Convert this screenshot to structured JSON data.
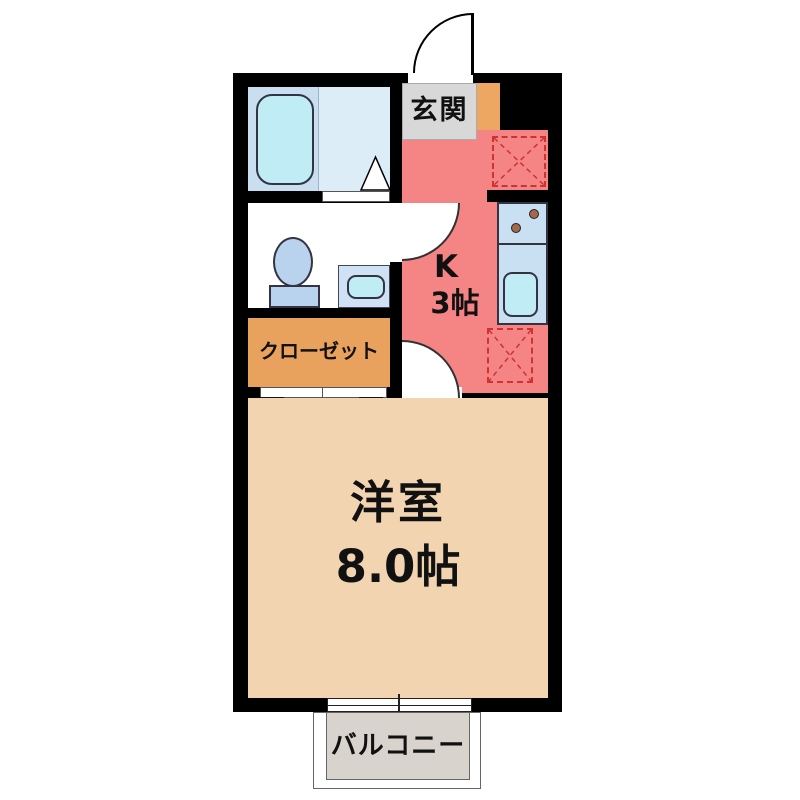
{
  "floorplan": {
    "rooms": {
      "entrance": {
        "label": "玄関"
      },
      "kitchen": {
        "label": "K",
        "size": "3帖"
      },
      "closet": {
        "label": "クローゼット"
      },
      "western_room": {
        "label": "洋室",
        "size": "8.0帖"
      },
      "balcony": {
        "label": "バルコニー"
      }
    },
    "fixtures": [
      "bathtub-icon",
      "bathroom-door-triangle-icon",
      "toilet-icon",
      "toilet-sink-icon",
      "entrance-door-arc-icon",
      "interior-door-arc-icon",
      "kitchen-counter-icon",
      "stove-burner-icon",
      "kitchen-sink-icon",
      "appliance-space-dashed-icon",
      "closet-door-triangle-icon",
      "sliding-window-icon"
    ],
    "colors": {
      "wall": "#000000",
      "kitchen_floor": "#f58585",
      "main_room_floor": "#f3d4b1",
      "closet_fill": "#e8a25d",
      "shoe_cabinet_fill": "#eda763",
      "entrance_fill": "#d8d8d8",
      "balcony_fill": "#d8d3cd",
      "bath_zone_left": "#c9def1",
      "bath_zone_right": "#ddedf8",
      "bathtub_fill": "#c0ecf5",
      "counter_fill": "#c9e0f3",
      "kitchen_sink_fill": "#c0ecf5",
      "toilet_fill": "#b9d3ee",
      "toilet_sink_outer": "#cfe2f5",
      "toilet_sink_inner": "#c0ecf5",
      "burner_fill": "#a4684f",
      "appliance_dashed": "#cc3333"
    }
  }
}
